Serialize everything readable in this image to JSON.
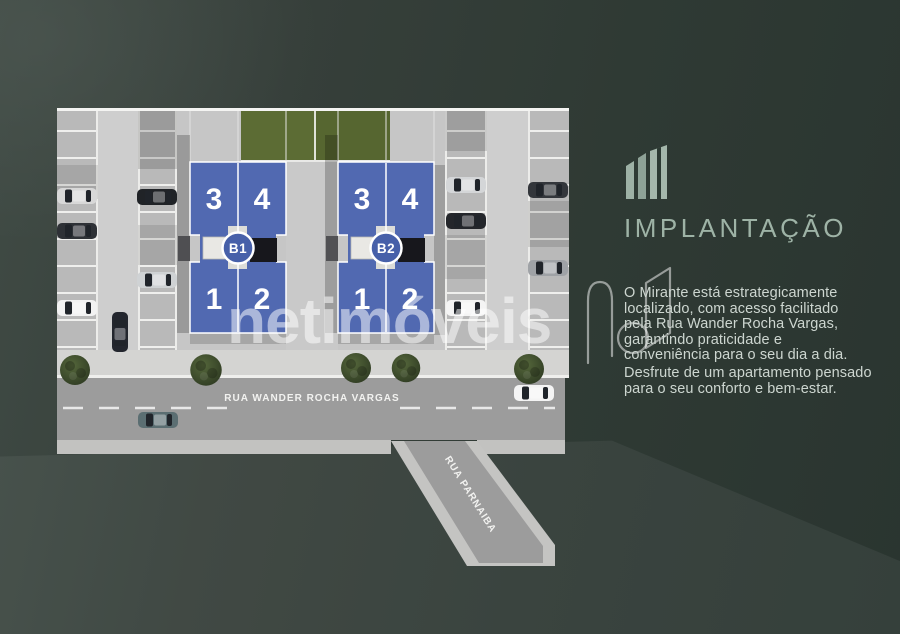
{
  "panel": {
    "title": "IMPLANTAÇÃO",
    "paragraph1": "O Mirante está estrategicamente\nlocalizado, com acesso facilitado\npela Rua Wander Rocha Vargas,\ngarantindo praticidade e\nconveniência para o seu dia a dia.",
    "paragraph2": "Desfrute de um apartamento pensado\npara o seu conforto e bem-estar."
  },
  "watermark": {
    "text": "netimóveis"
  },
  "plan": {
    "streets": {
      "main": "RUA WANDER ROCHA VARGAS",
      "side": "RUA PARNAIBA"
    },
    "buildings": [
      {
        "badge": "B1",
        "units": [
          "3",
          "4",
          "1",
          "2"
        ]
      },
      {
        "badge": "B2",
        "units": [
          "3",
          "4",
          "1",
          "2"
        ]
      }
    ]
  },
  "colors": {
    "background": "#333e38",
    "building_blue": "#5169b1",
    "badge_blue": "#4760a9",
    "grass_green": "#5c6c34",
    "accent_sage": "#9eb3a6",
    "pavement": "#c6c6c6",
    "street": "#9c9c9c"
  }
}
